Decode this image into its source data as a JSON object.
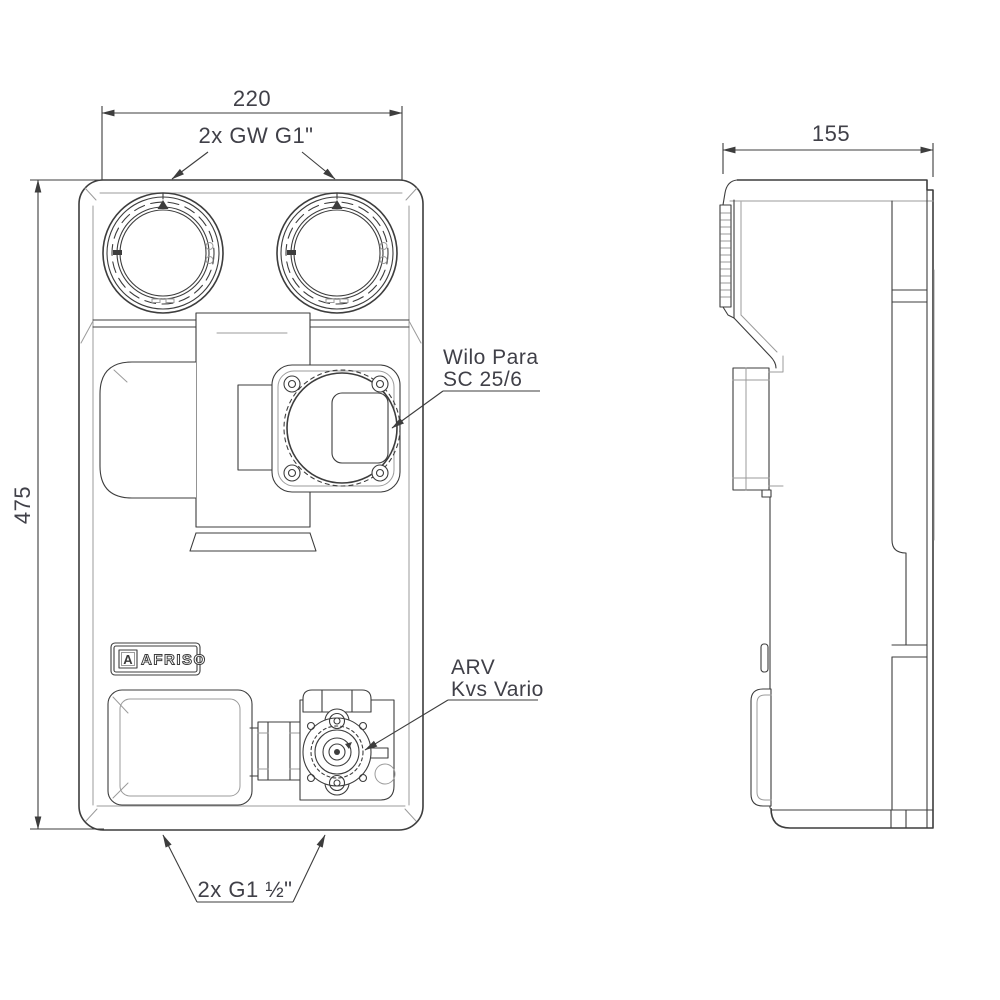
{
  "drawing": {
    "type": "technical-drawing",
    "product": "pump group with mixing valve, front and side view",
    "dimensions": {
      "width_mm": "220",
      "height_mm": "475",
      "depth_mm": "155"
    },
    "annotations": {
      "top_ports": "2x GW G1\"",
      "pump_line1": "Wilo Para",
      "pump_line2": "SC 25/6",
      "valve_line1": "ARV",
      "valve_line2": "Kvs Vario",
      "bottom_ports": "2x G1 ½\""
    },
    "logo": {
      "brand": "AFRISO",
      "icon_letter": "A"
    },
    "colors": {
      "line": "#3d3d3d",
      "light_line": "#9b9b9b",
      "text": "#404048",
      "background": "#ffffff"
    }
  }
}
